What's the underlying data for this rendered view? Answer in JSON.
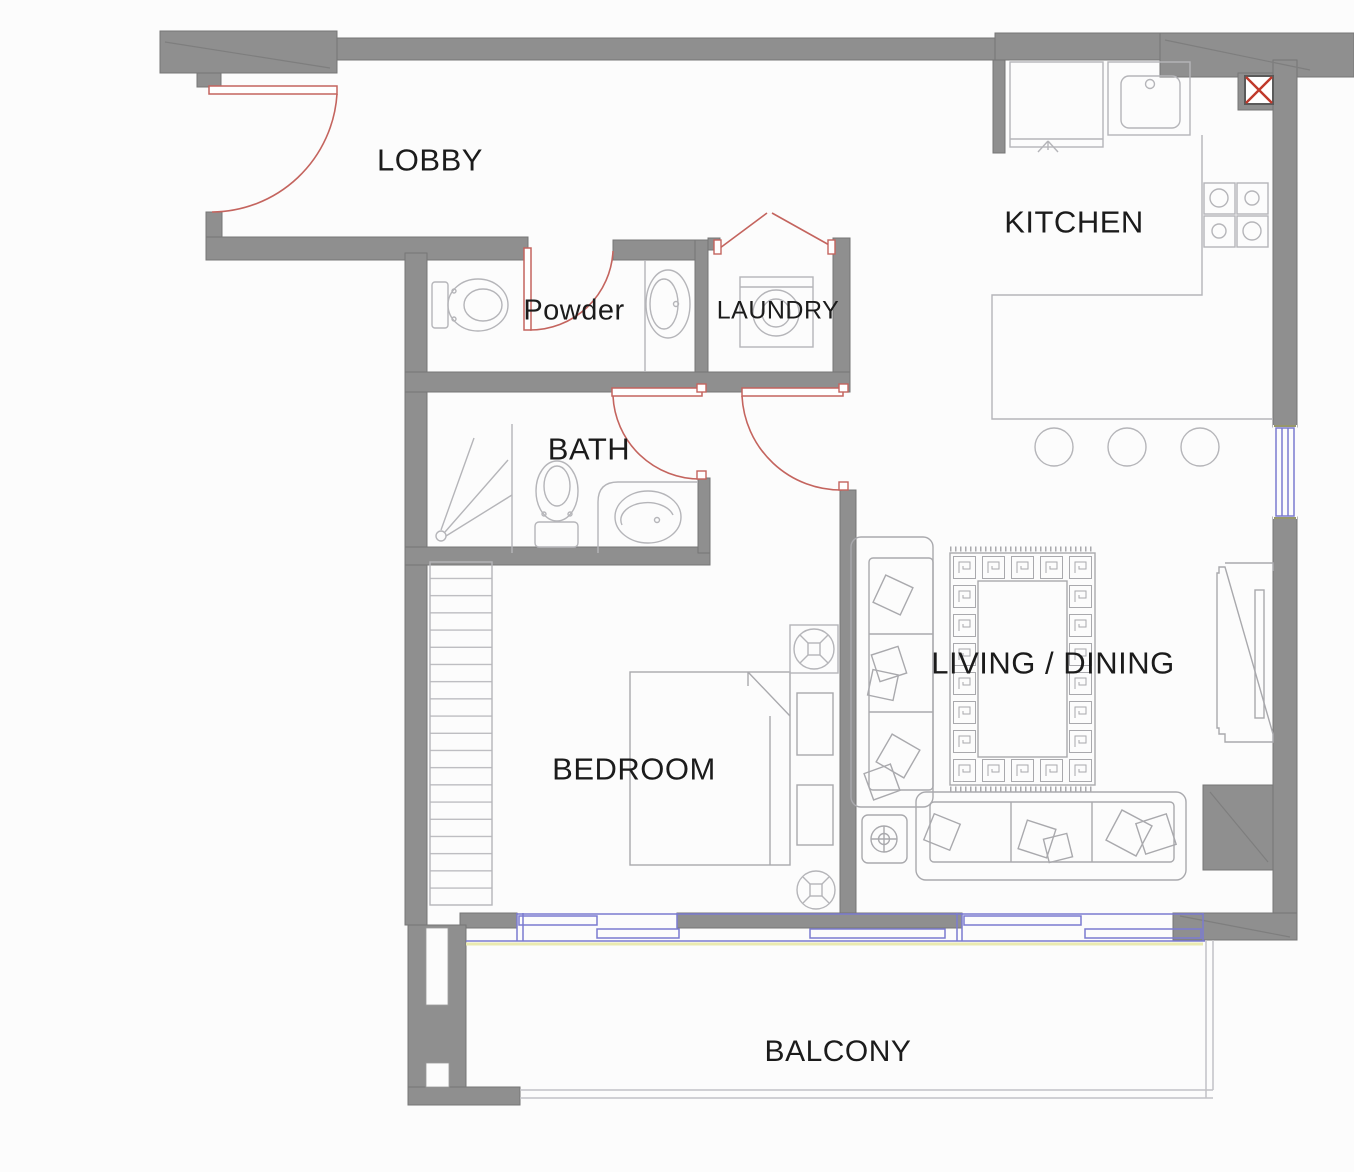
{
  "title": "apartment-floor-plan",
  "canvas": {
    "width": 1354,
    "height": 1172
  },
  "rooms": {
    "lobby": {
      "label": "LOBBY"
    },
    "kitchen": {
      "label": "KITCHEN"
    },
    "powder": {
      "label": "Powder"
    },
    "laundry": {
      "label": "LAUNDRY"
    },
    "bath": {
      "label": "BATH"
    },
    "bedroom": {
      "label": "BEDROOM"
    },
    "living": {
      "label": "LIVING / DINING"
    },
    "balcony": {
      "label": "BALCONY"
    }
  },
  "fixtures": [
    "entry-door-swing",
    "powder-door-swing",
    "bath-door-swing",
    "bedroom-door-swing",
    "laundry-bifold-door",
    "toilet-powder",
    "vanity-sink-powder",
    "washing-machine",
    "shower",
    "toilet-bath",
    "vanity-sink-bath",
    "fridge",
    "kitchen-sink",
    "stove-burners",
    "kitchen-counter",
    "bar-stools",
    "duct-shaft-x",
    "wardrobe",
    "double-bed",
    "nightstands",
    "ceiling-fans",
    "sofa-left",
    "sofa-bottom",
    "side-table",
    "area-rug-greek-key",
    "tv-console",
    "window-right",
    "sliding-doors",
    "balcony-railing"
  ],
  "colors": {
    "background": "#fcfcfc",
    "wall": "#8f8f8f",
    "wall_edge": "#767676",
    "fixture_line": "#b5b5b9",
    "furniture_line": "#a9a9ad",
    "door": "#c4645e",
    "window": "#7b7bd0",
    "railing": "#c2c2c6",
    "duct_x": "#c0392b",
    "label_text": "#1b1b1b"
  }
}
